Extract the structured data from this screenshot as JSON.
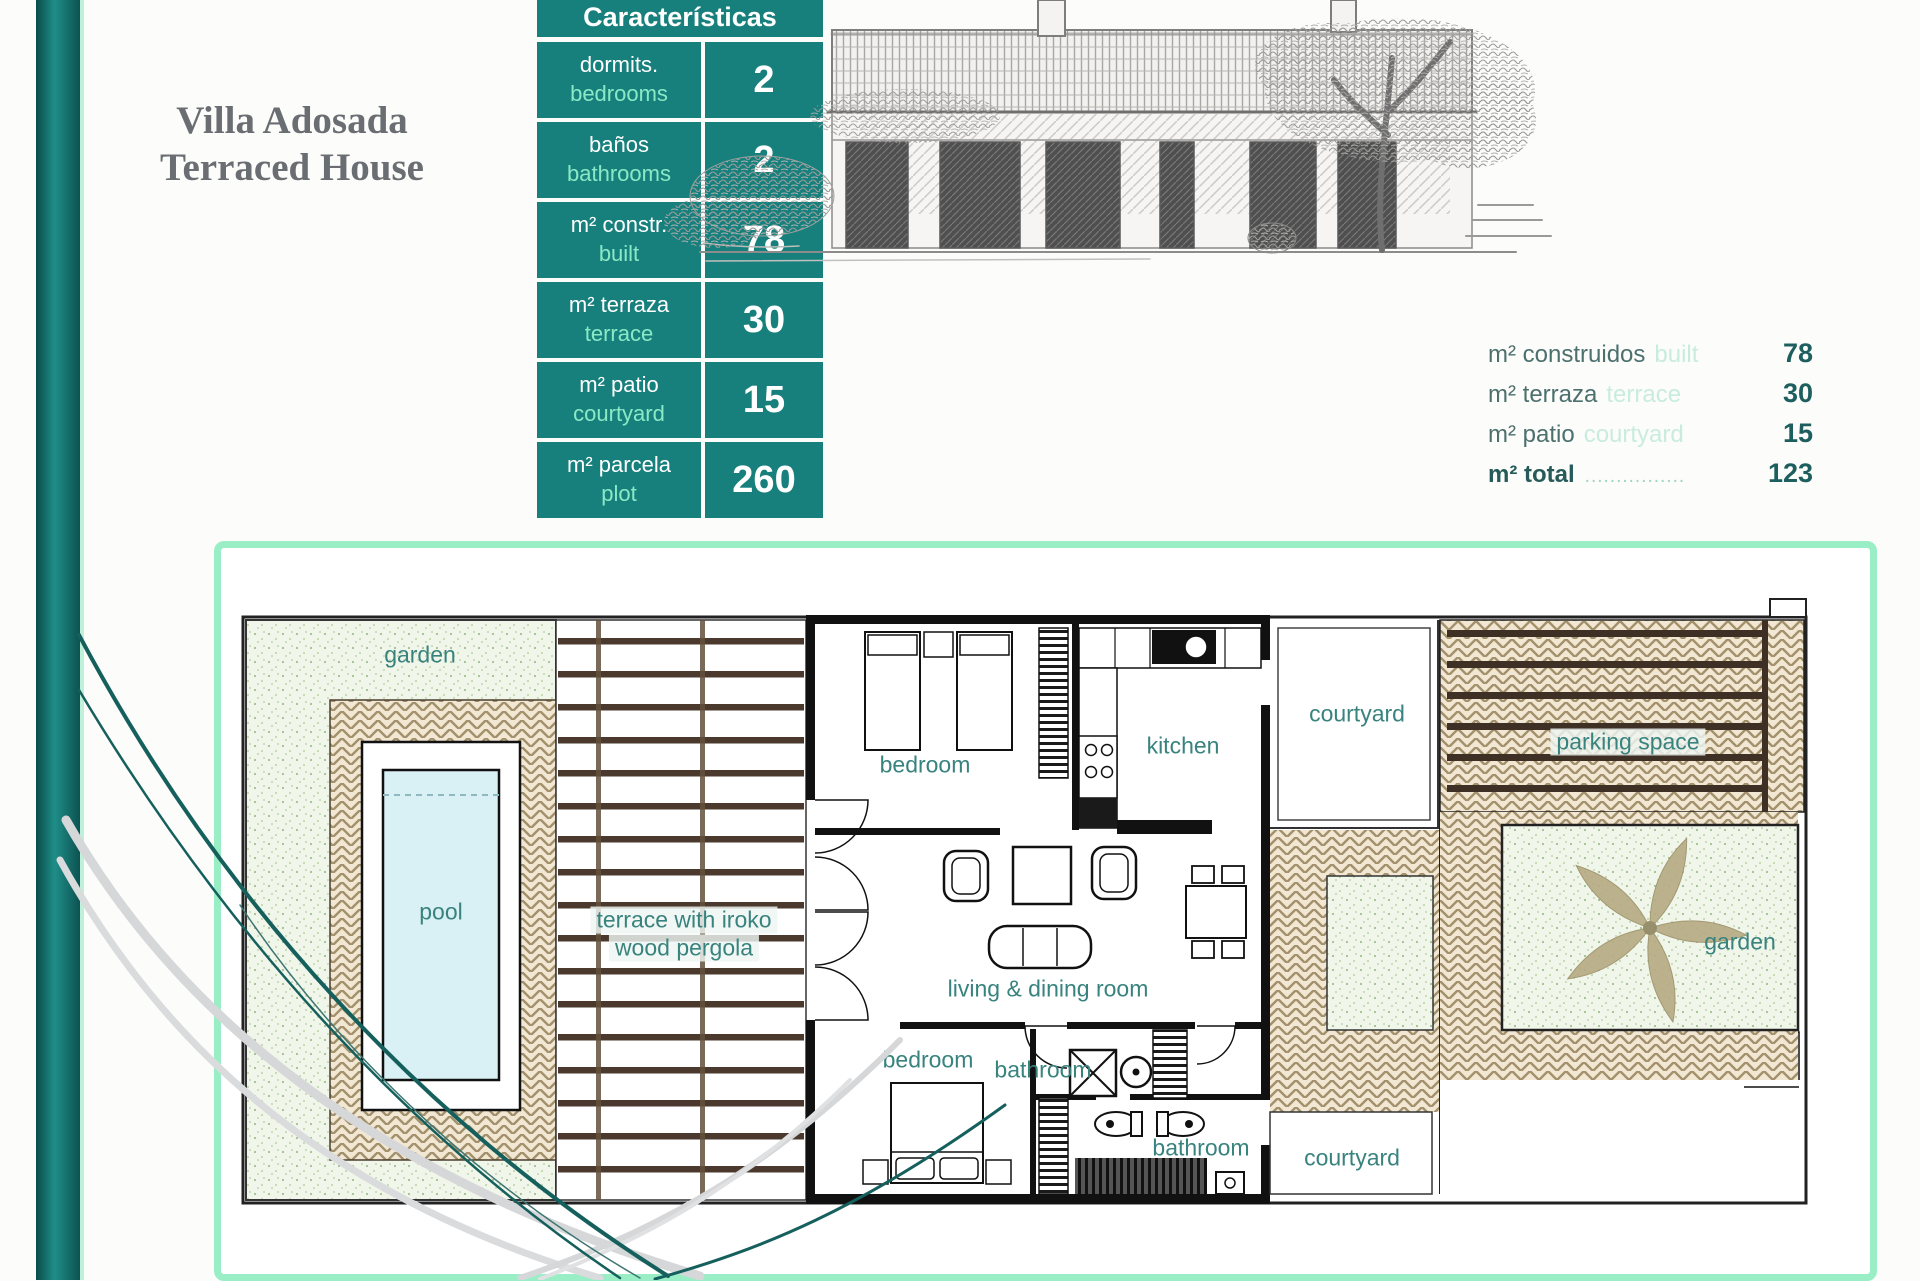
{
  "title": {
    "line1": "Villa Adosada",
    "line2": "Terraced House"
  },
  "table": {
    "header": "Características",
    "rows": [
      {
        "es": "dormits.",
        "en": "bedrooms",
        "value": "2"
      },
      {
        "es": "baños",
        "en": "bathrooms",
        "value": "2"
      },
      {
        "es": "m² constr.",
        "en": "built",
        "value": "78"
      },
      {
        "es": "m² terraza",
        "en": "terrace",
        "value": "30"
      },
      {
        "es": "m² patio",
        "en": "courtyard",
        "value": "15"
      },
      {
        "es": "m² parcela",
        "en": "plot",
        "value": "260"
      }
    ]
  },
  "summary": {
    "rows": [
      {
        "es": "m² construidos",
        "en": "built",
        "dots": "",
        "value": "78"
      },
      {
        "es": "m² terraza",
        "en": "terrace",
        "dots": "",
        "value": "30"
      },
      {
        "es": "m² patio",
        "en": "courtyard",
        "dots": "",
        "value": "15"
      },
      {
        "es": "m² total",
        "en": "",
        "dots": "................",
        "value": "123"
      }
    ]
  },
  "plan": {
    "labels": {
      "garden_left": "garden",
      "pool": "pool",
      "terrace_1": "terrace with iroko",
      "terrace_2": "wood pergola",
      "bedroom_top": "bedroom",
      "kitchen": "kitchen",
      "courtyard_top": "courtyard",
      "parking": "parking space",
      "garden_right": "garden",
      "living": "living & dining room",
      "bedroom_bottom": "bedroom",
      "bathroom_center": "bathroom",
      "bathroom_right": "bathroom",
      "courtyard_bottom": "courtyard"
    }
  },
  "colors": {
    "teal": "#17807d",
    "mint_text": "#8ae9c5",
    "mint_border": "#9aeec6",
    "summary_label": "#4c706e",
    "summary_light": "#c9ece0",
    "summary_value": "#1d5f5e",
    "plan_label": "#38837e",
    "title_gray": "#6a6e72",
    "paving_line": "#a3906c",
    "beam_brown": "#4a392c",
    "pool_blue": "#d9f0f4"
  }
}
